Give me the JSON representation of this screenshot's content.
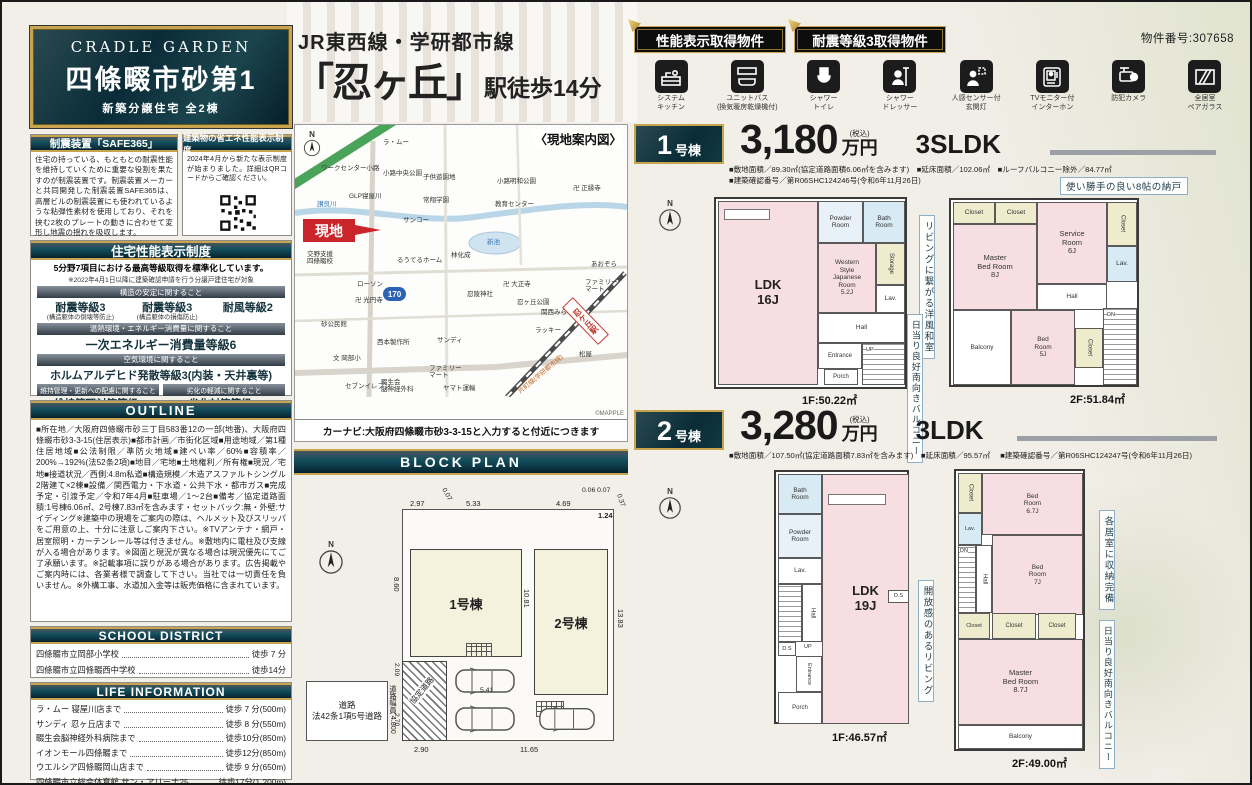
{
  "page": {
    "property_no": "物件番号:307658"
  },
  "title": {
    "line1": "JR東西線・学研都市線",
    "station": "「忍ヶ丘」",
    "suffix": "駅徒歩14分"
  },
  "logo": {
    "brand": "CRADLE GARDEN",
    "name": "四條畷市砂第1",
    "sub": "新築分譲住宅 全2棟"
  },
  "badges": {
    "b1": "性能表示取得物件",
    "b2": "耐震等級3取得物件"
  },
  "features": [
    "システム\nキッチン",
    "ユニットバス\n(換気暖房乾燥機付)",
    "シャワー\nトイレ",
    "シャワー\nドレッサー",
    "人感センサー付\n玄関灯",
    "TVモニター付\nインターホン",
    "防犯カメラ",
    "全居室\nペアガラス"
  ],
  "safe365": {
    "title": "制震装置「SAFE365」",
    "body": "住宅の持っている、もともとの耐震性能を維持していくために重要な役割を果たすのが制震装置です。制震装置メーカーと共同開発した制震装置SAFE365は、高層ビルの制震装置にも使われているような粘弾性素材を使用しており、それを挟む2枚のプレートの動きに合わせて変形し地震の揺れを吸収します。"
  },
  "energy": {
    "title": "建築物の省エネ性能表示制度",
    "body": "2024年4月から新たな表示制度が始まりました。詳細はQRコードからご確認ください。"
  },
  "performance": {
    "title": "住宅性能表示制度",
    "lead": "5分野7項目における最高等級取得を標準化しています。",
    "note": "※2022年4月1日以降に建築確認申請を行う分譲戸建住宅が対象",
    "s1": "構造の安定に関すること",
    "g1": "耐震等級3",
    "g1n": "(構造躯体の倒壊等防止)",
    "g2": "耐震等級3",
    "g2n": "(構造躯体の損傷防止)",
    "g3": "耐風等級2",
    "s2": "温熱環境・エネルギー消費量に関すること",
    "g4": "一次エネルギー消費量等級6",
    "s3": "空気環境に関すること",
    "g5": "ホルムアルデヒド発散等級3(内装・天井裏等)",
    "s4": "維持管理・更新への配慮に関すること",
    "s5": "劣化の軽減に関すること",
    "g6": "維持管理対策等級3",
    "g7": "劣化対策等級3"
  },
  "outline": {
    "title": "OUTLINE",
    "body": "■所在地／大阪府四條畷市砂三丁目583番12の一部(地番)、大阪府四條畷市砂3-3-15(住居表示)■都市計画／市街化区域■用途地域／第1種住居地域■公法制限／準防火地域■建ぺい率／60%■容積率／200%→192%(法52条2項)■地目／宅地■土地権利／所有権■現況／宅地■接道状況／西側:4.8m私道■構造規模／木造アスファルトシングル2階建て×2棟■設備／関西電力・下水道・公共下水・都市ガス■完成予定・引渡予定／令和7年4月■駐車場／1〜2台■備考／協定道路面積:1号棟6.06㎡、2号棟7.83㎡を含みます・セットバック:無・外壁:サイディング※建築中の現場をご案内の際は、ヘルメット及びスリッパをご用意の上、十分に注意しご案内下さい。※TVアンテナ・網戸・居室照明・カーテンレール等は付きません。※敷地内に電柱及び支線が入る場合があります。※図面と現況が異なる場合は現況優先にてご了承願います。※記載事項に誤りがある場合があります。広告掲載やご案内時には、各業者様で調査して下さい。当社では一切責任を負いません。※外構工事、水道加入金等は販売価格に含まれています。"
  },
  "school": {
    "title": "SCHOOL DISTRICT",
    "items": [
      {
        "name": "四條畷市立岡部小学校",
        "dist": "徒歩 7 分"
      },
      {
        "name": "四條畷市立四條畷西中学校",
        "dist": "徒歩14分"
      }
    ]
  },
  "life": {
    "title": "LIFE INFORMATION",
    "items": [
      {
        "name": "ラ・ムー 寝屋川店まで",
        "dist": "徒歩 7 分(500m)"
      },
      {
        "name": "サンディ 忍ヶ丘店まで",
        "dist": "徒歩 8 分(550m)"
      },
      {
        "name": "畷生会脳神経外科病院まで",
        "dist": "徒歩10分(850m)"
      },
      {
        "name": "イオンモール四條畷まで",
        "dist": "徒歩12分(850m)"
      },
      {
        "name": "ウエルシア四條畷岡山店まで",
        "dist": "徒歩 9 分(650m)"
      },
      {
        "name": "四條畷市立総合体育館 サン・アリーナ25",
        "dist": "徒歩17分(1,200m)"
      }
    ]
  },
  "map": {
    "title": "〈現地案内図〉",
    "site": "現地",
    "route": "170",
    "station": "忍ケ丘駅",
    "caption": "カーナビ:大阪府四條畷市砂3-3-15と入力すると付近につきます",
    "credit": "©MAPPLE",
    "labels": [
      "ラ・ムー",
      "ワークセンター小路",
      "小路中央公園",
      "子供遊園地",
      "小路明和公園",
      "卍 正縁寺",
      "GLP寝屋川",
      "常翔学園",
      "教育センター",
      "讃良川",
      "サンコー",
      "新池",
      "交野支援\n四條畷校",
      "るうてるホーム",
      "林化成",
      "あおぞら",
      "ローソン",
      "卍 光円寺",
      "卍 大正寺",
      "忍陵神社",
      "忍ヶ丘公園",
      "ファミリー\nマート",
      "関西みらい",
      "ラッキー",
      "砂公民館",
      "西本製作所",
      "サンディ",
      "文 岡部小",
      "ファミリー\nマート",
      "セブンイレブン",
      "畷生会\n脳神経外科",
      "ヤマト運輸",
      "松屋",
      "片町線(学研都市線)"
    ]
  },
  "blockplan": {
    "title": "BLOCK PLAN",
    "u1": "1号棟",
    "u2": "2号棟",
    "road": "道路\n法42条1項5号道路",
    "roadw": "道路幅員\n4.800",
    "kyotei": "協定道路",
    "dims": {
      "d1": "2.97",
      "d2": "0.07",
      "d3": "5.33",
      "d4": "4.69",
      "d5": "0.06 0.07",
      "d6": "0.37",
      "d7": "1.24",
      "d8": "8.60",
      "d9": "10.81",
      "d10": "13.83",
      "d11": "2.09",
      "d12": "2.70",
      "d13": "2.90",
      "d14": "11.65",
      "d15": "5.41"
    }
  },
  "units": [
    {
      "no": "1",
      "suffix": "号棟",
      "price": "3,180",
      "tax": "(税込)",
      "yen": "万円",
      "layout": "3SLDK",
      "spec1": "■敷地面積／89.30㎡(協定道路面積6.06㎡を含みます)　■延床面積／102.06㎡　■ルーフバルコニー除外／84.77㎡",
      "spec2": "■建築確認番号／第R06SHC124246号(令和6年11月26日)",
      "callout_top": "使い勝手の良い8帖の納戸",
      "callout_v1": "リビングに繋がる洋風和室",
      "callout_v2": "日当り良好南向きバルコニー",
      "f1": {
        "area": "1F:50.22㎡",
        "rooms": {
          "ldk": "LDK\n16J",
          "wjr": "Western\nStyle\nJapanese\nRoom\n5.2J",
          "powder": "Powder\nRoom",
          "bath": "Bath\nRoom",
          "storage": "Storage",
          "hall": "Hall",
          "lav": "Lav.",
          "entrance": "Entrance",
          "porch": "Porch",
          "up": "UP"
        }
      },
      "f2": {
        "area": "2F:51.84㎡",
        "rooms": {
          "master": "Master\nBed Room\n8J",
          "service": "Service\nRoom\n6J",
          "bed": "Bed\nRoom\n5J",
          "c1": "Closet",
          "c2": "Closet",
          "c3": "Closet",
          "c4": "Closet",
          "lav": "Lav.",
          "hall": "Hall",
          "balcony": "Balcony",
          "dn": "DN"
        }
      }
    },
    {
      "no": "2",
      "suffix": "号棟",
      "price": "3,280",
      "tax": "(税込)",
      "yen": "万円",
      "layout": "3LDK",
      "spec1": "■敷地面積／107.50㎡(協定道路面積7.83㎡を含みます)　■延床面積／95.57㎡",
      "spec2": "■建築確認番号／第R06SHC124247号(令和6年11月26日)",
      "callout_v1": "開放感のあるリビング",
      "callout_v2": "各居室に収納完備",
      "callout_v3": "日当り良好南向きバルコニー",
      "f1": {
        "area": "1F:46.57㎡",
        "rooms": {
          "ldk": "LDK\n19J",
          "bath": "Bath\nRoom",
          "powder": "Powder\nRoom",
          "lav": "Lav.",
          "hall": "Hall",
          "up": "UP",
          "ds1": "D.S",
          "ds2": "D.S",
          "entrance": "Entrance",
          "porch": "Porch"
        }
      },
      "f2": {
        "area": "2F:49.00㎡",
        "rooms": {
          "bed1": "Bed\nRoom\n6.7J",
          "bed2": "Bed\nRoom\n7J",
          "master": "Master\nBed Room\n8.7J",
          "c1": "Closet",
          "c2": "Closet",
          "c3": "Closet",
          "c4": "Closet",
          "lav": "Lav.",
          "hall": "Hall",
          "dn": "DN",
          "balcony": "Balcony"
        }
      }
    }
  ]
}
